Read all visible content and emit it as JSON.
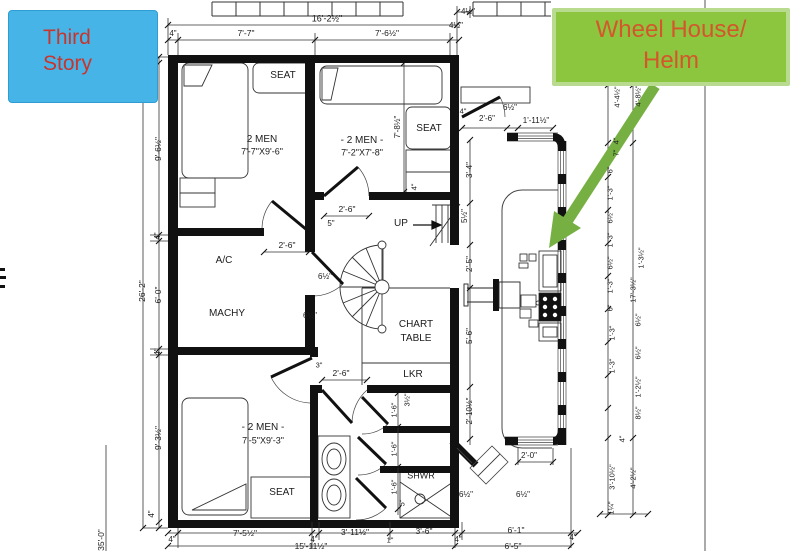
{
  "annotations": {
    "third_story": {
      "line1": "Third",
      "line2": "Story",
      "bg": "#47b4e8",
      "text_color": "#c8352c"
    },
    "wheelhouse": {
      "line1": "Wheel House/",
      "line2": "Helm",
      "bg": "#8cc63f",
      "text_color": "#d4572c",
      "arrow_color": "#76b043"
    }
  },
  "plan_labels": [
    {
      "t": "SEAT",
      "x": 283,
      "y": 76,
      "r": 0,
      "s": 10,
      "n": "room-label-seat-1"
    },
    {
      "t": "2 MEN",
      "x": 262,
      "y": 140,
      "r": 0,
      "s": 10,
      "n": "room-label-2men-1"
    },
    {
      "t": "7'-7\"X9'-6\"",
      "x": 262,
      "y": 152,
      "r": 0,
      "s": 9,
      "n": "room-size-2men-1"
    },
    {
      "t": "- 2 MEN -",
      "x": 362,
      "y": 141,
      "r": 0,
      "s": 10,
      "n": "room-label-2men-2"
    },
    {
      "t": "7'-2\"X7'-8\"",
      "x": 362,
      "y": 153,
      "r": 0,
      "s": 9,
      "n": "room-size-2men-2"
    },
    {
      "t": "SEAT",
      "x": 429,
      "y": 129,
      "r": 0,
      "s": 10,
      "n": "room-label-seat-2"
    },
    {
      "t": "A/C",
      "x": 224,
      "y": 261,
      "r": 0,
      "s": 10,
      "n": "room-label-ac"
    },
    {
      "t": "MACHY",
      "x": 227,
      "y": 314,
      "r": 0,
      "s": 10,
      "n": "room-label-machy"
    },
    {
      "t": "CHART",
      "x": 416,
      "y": 325,
      "r": 0,
      "s": 10,
      "n": "room-label-chart"
    },
    {
      "t": "TABLE",
      "x": 416,
      "y": 339,
      "r": 0,
      "s": 10,
      "n": "room-label-table"
    },
    {
      "t": "LKR",
      "x": 413,
      "y": 375,
      "r": 0,
      "s": 10,
      "n": "room-label-lkr"
    },
    {
      "t": "UP",
      "x": 401,
      "y": 224,
      "r": 0,
      "s": 10,
      "n": "stair-label-up"
    },
    {
      "t": "- 2 MEN -",
      "x": 263,
      "y": 428,
      "r": 0,
      "s": 10,
      "n": "room-label-2men-3"
    },
    {
      "t": "7'-5\"X9'-3\"",
      "x": 263,
      "y": 441,
      "r": 0,
      "s": 9,
      "n": "room-size-2men-3"
    },
    {
      "t": "SEAT",
      "x": 282,
      "y": 493,
      "r": 0,
      "s": 10,
      "n": "room-label-seat-3"
    },
    {
      "t": "SHWR",
      "x": 421,
      "y": 476,
      "r": 0,
      "s": 9,
      "n": "room-label-shwr"
    },
    {
      "t": "16'-2½\"",
      "x": 327,
      "y": 19,
      "r": 0,
      "s": 9
    },
    {
      "t": "4½\"",
      "x": 468,
      "y": 12,
      "r": 0,
      "s": 8
    },
    {
      "t": "4\"",
      "x": 173,
      "y": 34,
      "r": 0,
      "s": 8
    },
    {
      "t": "7'-7\"",
      "x": 246,
      "y": 33,
      "r": 0,
      "s": 8.5
    },
    {
      "t": "7'-6½\"",
      "x": 387,
      "y": 33,
      "r": 0,
      "s": 8.5
    },
    {
      "t": "4½\"",
      "x": 456,
      "y": 26,
      "r": 0,
      "s": 8
    },
    {
      "t": "6½\"",
      "x": 510,
      "y": 108,
      "r": 0,
      "s": 8
    },
    {
      "t": "1'-11½\"",
      "x": 536,
      "y": 121,
      "r": 0,
      "s": 8
    },
    {
      "t": "4\"",
      "x": 463,
      "y": 111,
      "r": 0,
      "s": 7.5
    },
    {
      "t": "2'-6\"",
      "x": 487,
      "y": 119,
      "r": 0,
      "s": 8
    },
    {
      "t": "2'-6\"",
      "x": 347,
      "y": 209,
      "r": 0,
      "s": 8.5
    },
    {
      "t": "5\"",
      "x": 331,
      "y": 224,
      "r": 0,
      "s": 8
    },
    {
      "t": "2'-6\"",
      "x": 287,
      "y": 245,
      "r": 0,
      "s": 8.5
    },
    {
      "t": "6½\"",
      "x": 325,
      "y": 277,
      "r": 0,
      "s": 8
    },
    {
      "t": "6½\"",
      "x": 310,
      "y": 316,
      "r": 0,
      "s": 8
    },
    {
      "t": "2'-6\"",
      "x": 341,
      "y": 373,
      "r": 0,
      "s": 8.5
    },
    {
      "t": "3\"",
      "x": 319,
      "y": 365,
      "r": 0,
      "s": 7.5
    },
    {
      "t": "2'-0\"",
      "x": 529,
      "y": 456,
      "r": 0,
      "s": 8
    },
    {
      "t": "6½\"",
      "x": 466,
      "y": 495,
      "r": 0,
      "s": 8
    },
    {
      "t": "6½\"",
      "x": 523,
      "y": 495,
      "r": 0,
      "s": 8
    },
    {
      "t": "4\"",
      "x": 172,
      "y": 540,
      "r": 0,
      "s": 8
    },
    {
      "t": "7'-5½\"",
      "x": 245,
      "y": 533,
      "r": 0,
      "s": 8.5
    },
    {
      "t": "4\"",
      "x": 314,
      "y": 540,
      "r": 0,
      "s": 8
    },
    {
      "t": "3'-11½\"",
      "x": 355,
      "y": 532,
      "r": 0,
      "s": 8.5
    },
    {
      "t": "1\"",
      "x": 390,
      "y": 540,
      "r": 0,
      "s": 7.5
    },
    {
      "t": "3'-6\"",
      "x": 424,
      "y": 531,
      "r": 0,
      "s": 8.5
    },
    {
      "t": "4\"",
      "x": 458,
      "y": 540,
      "r": 0,
      "s": 8
    },
    {
      "t": "6'-1\"",
      "x": 516,
      "y": 530,
      "r": 0,
      "s": 8.5
    },
    {
      "t": "4\"",
      "x": 573,
      "y": 538,
      "r": 0,
      "s": 8
    },
    {
      "t": "15'-11½\"",
      "x": 311,
      "y": 546,
      "r": 0,
      "s": 8.5
    },
    {
      "t": "6'-5\"",
      "x": 513,
      "y": 546,
      "r": 0,
      "s": 8.5
    },
    {
      "t": "26'-2\"",
      "x": 142,
      "y": 291,
      "r": 1,
      "s": 8.5
    },
    {
      "t": "9'-6½\"",
      "x": 158,
      "y": 149,
      "r": 1,
      "s": 8.5
    },
    {
      "t": "4\"",
      "x": 158,
      "y": 236,
      "r": 1,
      "s": 8
    },
    {
      "t": "6'-0\"",
      "x": 158,
      "y": 295,
      "r": 1,
      "s": 8.5
    },
    {
      "t": "4\"",
      "x": 158,
      "y": 352,
      "r": 1,
      "s": 8
    },
    {
      "t": "9'-3½\"",
      "x": 158,
      "y": 438,
      "r": 1,
      "s": 8.5
    },
    {
      "t": "4\"",
      "x": 152,
      "y": 514,
      "r": 1,
      "s": 8
    },
    {
      "t": "35'-0\"",
      "x": 101,
      "y": 540,
      "r": 1,
      "s": 8.5
    },
    {
      "t": "7'-8½\"",
      "x": 398,
      "y": 127,
      "r": 1,
      "s": 8
    },
    {
      "t": "4\"",
      "x": 414,
      "y": 187,
      "r": 1,
      "s": 7.5
    },
    {
      "t": "3'-4\"",
      "x": 470,
      "y": 170,
      "r": 1,
      "s": 8
    },
    {
      "t": "5½\"",
      "x": 465,
      "y": 216,
      "r": 1,
      "s": 8
    },
    {
      "t": "2'-5\"",
      "x": 470,
      "y": 264,
      "r": 1,
      "s": 8
    },
    {
      "t": "5'-6\"",
      "x": 470,
      "y": 336,
      "r": 1,
      "s": 8
    },
    {
      "t": "2'-10½\"",
      "x": 470,
      "y": 411,
      "r": 1,
      "s": 8
    },
    {
      "t": "3½\"",
      "x": 407,
      "y": 400,
      "r": 1,
      "s": 7.5
    },
    {
      "t": "1'-6\"",
      "x": 394,
      "y": 410,
      "r": 1,
      "s": 7.5
    },
    {
      "t": "1'-6\"",
      "x": 394,
      "y": 449,
      "r": 1,
      "s": 7.5
    },
    {
      "t": "1'-6\"",
      "x": 394,
      "y": 487,
      "r": 1,
      "s": 7.5
    },
    {
      "t": "5\"",
      "x": 402,
      "y": 503,
      "r": 1,
      "s": 7.5
    },
    {
      "t": "4'-4½\"",
      "x": 617,
      "y": 97,
      "r": 1,
      "s": 7.5
    },
    {
      "t": "4'-8½\"",
      "x": 638,
      "y": 96,
      "r": 1,
      "s": 7.5
    },
    {
      "t": "4\"",
      "x": 616,
      "y": 141,
      "r": 1,
      "s": 7.5
    },
    {
      "t": "7\"",
      "x": 616,
      "y": 153,
      "r": 1,
      "s": 7.5
    },
    {
      "t": "6\"",
      "x": 610,
      "y": 170,
      "r": 1,
      "s": 7.5
    },
    {
      "t": "1'-3\"",
      "x": 610,
      "y": 193,
      "r": 1,
      "s": 7.5
    },
    {
      "t": "6½\"",
      "x": 610,
      "y": 217,
      "r": 1,
      "s": 7.5
    },
    {
      "t": "1'-3\"",
      "x": 610,
      "y": 240,
      "r": 1,
      "s": 7.5
    },
    {
      "t": "6½\"",
      "x": 610,
      "y": 263,
      "r": 1,
      "s": 7.5
    },
    {
      "t": "1'-3\"",
      "x": 610,
      "y": 286,
      "r": 1,
      "s": 7.5
    },
    {
      "t": "6\"",
      "x": 610,
      "y": 308,
      "r": 1,
      "s": 7.5
    },
    {
      "t": "1'-3\"",
      "x": 612,
      "y": 333,
      "r": 1,
      "s": 7.5
    },
    {
      "t": "1'-3\"",
      "x": 612,
      "y": 366,
      "r": 1,
      "s": 7.5
    },
    {
      "t": "1'-3½\"",
      "x": 641,
      "y": 258,
      "r": 1,
      "s": 7.5
    },
    {
      "t": "17'-3½\"",
      "x": 633,
      "y": 290,
      "r": 1,
      "s": 7.5
    },
    {
      "t": "6½\"",
      "x": 638,
      "y": 320,
      "r": 1,
      "s": 7.5
    },
    {
      "t": "6½\"",
      "x": 638,
      "y": 353,
      "r": 1,
      "s": 7.5
    },
    {
      "t": "1'-2½\"",
      "x": 638,
      "y": 387,
      "r": 1,
      "s": 7.5
    },
    {
      "t": "8½\"",
      "x": 638,
      "y": 413,
      "r": 1,
      "s": 7.5
    },
    {
      "t": "4\"",
      "x": 622,
      "y": 439,
      "r": 1,
      "s": 7.5
    },
    {
      "t": "3'-10½\"",
      "x": 612,
      "y": 477,
      "r": 1,
      "s": 7.5
    },
    {
      "t": "4'-2½\"",
      "x": 633,
      "y": 478,
      "r": 1,
      "s": 7.5
    },
    {
      "t": "1¼\"",
      "x": 611,
      "y": 508,
      "r": 1,
      "s": 7.5
    }
  ]
}
